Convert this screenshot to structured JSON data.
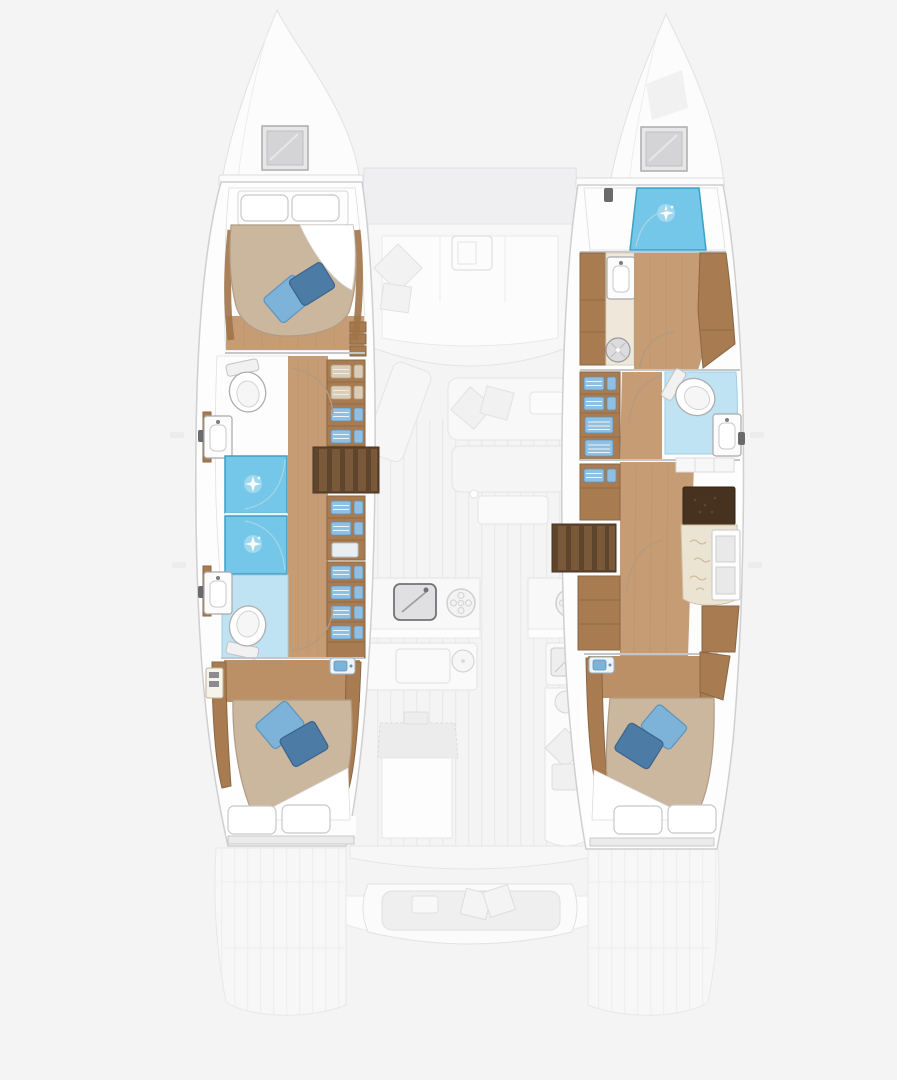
{
  "page": {
    "title": "Catamaran yacht interior layout — top-down floor plan",
    "background": "#f4f4f4",
    "text_content": "none — drawing only, no visible text in screenshot"
  },
  "colors": {
    "bg": "#f4f4f4",
    "hull": "#fdfdfd",
    "hullLine": "#cfcfd1",
    "fadeLine": "#e4e4e6",
    "fadePanel": "#f7f7f8",
    "fadePanel2": "#efeff1",
    "wood": "#c59c74",
    "woodGrain": "#b98f66",
    "woodTrim": "#a87c50",
    "woodTrimDark": "#8a6644",
    "stairs": "#5f452c",
    "stairTread": "#7a593a",
    "desk": "#46321f",
    "duvet": "#cbb69e",
    "duvetEdge": "#b09c85",
    "sheet": "#ffffff",
    "pillowEdge": "#c8c8ca",
    "cushLight": "#7db3d9",
    "cushLightEdge": "#5d93bd",
    "cushDark": "#4c7ba6",
    "cushDarkEdge": "#3a648c",
    "shower": "#74c7e8",
    "showerEdge": "#3f9fc4",
    "bathFloor": "#bfe3f2",
    "bathFloorEdge": "#9fcee2",
    "clothesBlue": "#8fc0e4",
    "clothesBeige": "#d9ccb8",
    "cream": "#efe8da",
    "creamEdge": "#d8cfc0",
    "seatCream": "#ece4d2",
    "seatCreamEdge": "#cdbfa4",
    "fixture": "#9a9a9c",
    "wall": "#c6c6c8",
    "doorArc": "#b59a7e"
  },
  "vessel": {
    "type": "catamaran",
    "view": "top-down interior floor plan; lower-deck hulls in full color, main deck rendered faded",
    "port_hull": {
      "position": "left",
      "rooms": [
        {
          "name": "forward-double-cabin",
          "fixtures": [
            "double-bed",
            "white-pillow x2",
            "blue-cushion x2",
            "overhead-hatch",
            "side-drawers"
          ]
        },
        {
          "name": "forward-bathroom",
          "fixtures": [
            "toilet",
            "washbasin"
          ]
        },
        {
          "name": "shower-compartments",
          "fixtures": [
            "shower x2"
          ]
        },
        {
          "name": "aft-bathroom",
          "fixtures": [
            "toilet",
            "washbasin"
          ]
        },
        {
          "name": "wardrobe-column",
          "fixtures": [
            "shelves-with-folded-clothes x3"
          ]
        },
        {
          "name": "companionway-stairs",
          "fixtures": [
            "steps"
          ]
        },
        {
          "name": "aft-double-cabin",
          "fixtures": [
            "double-bed",
            "white-pillow x2",
            "blue-cushion x2",
            "vanity-washbasin",
            "locker"
          ]
        }
      ]
    },
    "starboard_hull": {
      "position": "right",
      "rooms": [
        {
          "name": "bow-shower-room",
          "fixtures": [
            "shower",
            "overhead-hatch"
          ]
        },
        {
          "name": "forward-bathroom",
          "fixtures": [
            "washbasin-unit",
            "round-basin",
            "wardrobe"
          ]
        },
        {
          "name": "mid-bathroom",
          "fixtures": [
            "toilet",
            "washbasin"
          ]
        },
        {
          "name": "wardrobe-column",
          "fixtures": [
            "shelves-with-folded-clothes x2"
          ]
        },
        {
          "name": "companionway-stairs",
          "fixtures": [
            "steps"
          ]
        },
        {
          "name": "nav-desk-area",
          "fixtures": [
            "desk",
            "seat",
            "cubby-shelves",
            "lockers"
          ]
        },
        {
          "name": "aft-double-cabin",
          "fixtures": [
            "double-bed",
            "white-pillow x2",
            "blue-cushion x2",
            "vanity-washbasin"
          ]
        }
      ]
    },
    "main_deck_faded": {
      "areas": [
        {
          "name": "foredeck-lounge",
          "fixtures": [
            "u-sofa",
            "coffee-table",
            "cushions"
          ]
        },
        {
          "name": "saloon",
          "fixtures": [
            "chaise",
            "sofa",
            "cushions",
            "coffee-table"
          ]
        },
        {
          "name": "galley",
          "fixtures": [
            "sink",
            "cooktop-burner x2",
            "worktop x2",
            "island",
            "round-fixture"
          ]
        },
        {
          "name": "aft-cockpit",
          "fixtures": [
            "bench-seat",
            "cushions"
          ]
        },
        {
          "name": "swim-platforms",
          "fixtures": [
            "stern-platform x2"
          ]
        }
      ]
    }
  }
}
